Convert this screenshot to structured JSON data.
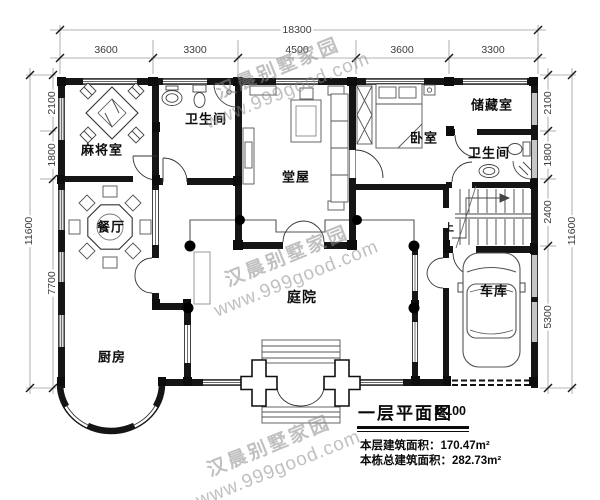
{
  "watermark": {
    "line1": "汉晨别墅家园",
    "line2": "www.999good.com"
  },
  "dims": {
    "top_total": "18300",
    "top_segments": [
      "3600",
      "3300",
      "4500",
      "3600",
      "3300"
    ],
    "left_total": "11600",
    "left_segments": [
      "2100",
      "1800",
      "7700"
    ],
    "right_total": "11600",
    "right_segments": [
      "2100",
      "1800",
      "2400",
      "5300"
    ]
  },
  "rooms": {
    "mahjong": "麻将室",
    "bath_top": "卫生间",
    "hall": "堂屋",
    "bedroom": "卧室",
    "storage": "储藏室",
    "bath_right": "卫生间",
    "dining": "餐厅",
    "courtyard": "庭院",
    "garage": "车库",
    "kitchen": "厨房"
  },
  "stairs": {
    "up_label": "上"
  },
  "title_block": {
    "title": "一层平面图",
    "scale": "1:100",
    "floor_area_line": "本层建筑面积：170.47m²",
    "total_area_line": "本栋总建筑面积：282.73m²"
  }
}
